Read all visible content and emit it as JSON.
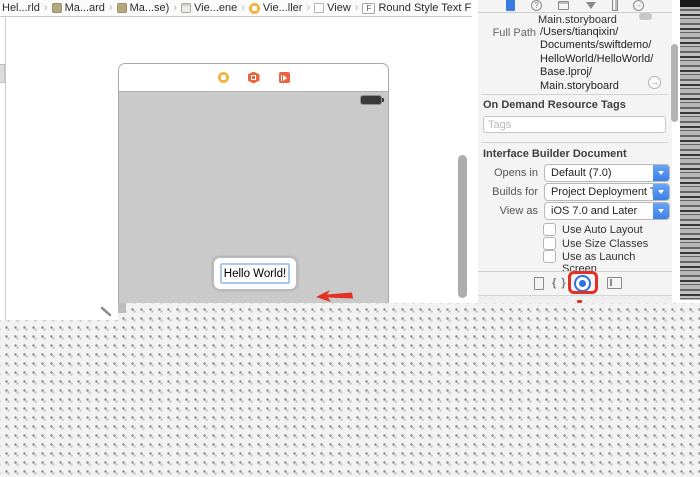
{
  "breadcrumb": {
    "separator": "›",
    "items": [
      {
        "label": "Hel...rld"
      },
      {
        "label": "Ma...ard"
      },
      {
        "label": "Ma...se)"
      },
      {
        "label": "Vie...ene"
      },
      {
        "label": "Vie...ller"
      },
      {
        "label": "View"
      },
      {
        "label": "Round Style Text Field"
      }
    ]
  },
  "canvas": {
    "text_field_value": "Hello World!"
  },
  "inspector": {
    "location_value": "Main.storyboard",
    "full_path": {
      "label": "Full Path",
      "lines": [
        "/Users/tianqixin/",
        "Documents/swiftdemo/",
        "HelloWorld/HelloWorld/",
        "Base.lproj/",
        "Main.storyboard"
      ]
    },
    "on_demand": {
      "header": "On Demand Resource Tags",
      "tags_placeholder": "Tags"
    },
    "ib_document": {
      "header": "Interface Builder Document",
      "rows": [
        {
          "label": "Opens in",
          "value": "Default (7.0)"
        },
        {
          "label": "Builds for",
          "value": "Project Deployment T..."
        },
        {
          "label": "View as",
          "value": "iOS 7.0 and Later"
        }
      ],
      "checkboxes": [
        {
          "label": "Use Auto Layout",
          "checked": false
        },
        {
          "label": "Use Size Classes",
          "checked": false
        },
        {
          "label": "Use as Launch Screen",
          "checked": false
        }
      ]
    }
  },
  "icons": {
    "f_badge": "F",
    "arrow_right": "→",
    "question": "?",
    "braces": "{ }"
  },
  "colors": {
    "accent_blue": "#3a7de8",
    "annotation_red": "#e23022",
    "vc_yellow": "#f4b43b",
    "responder_orange": "#e8653e",
    "device_gray": "#cacaca"
  }
}
